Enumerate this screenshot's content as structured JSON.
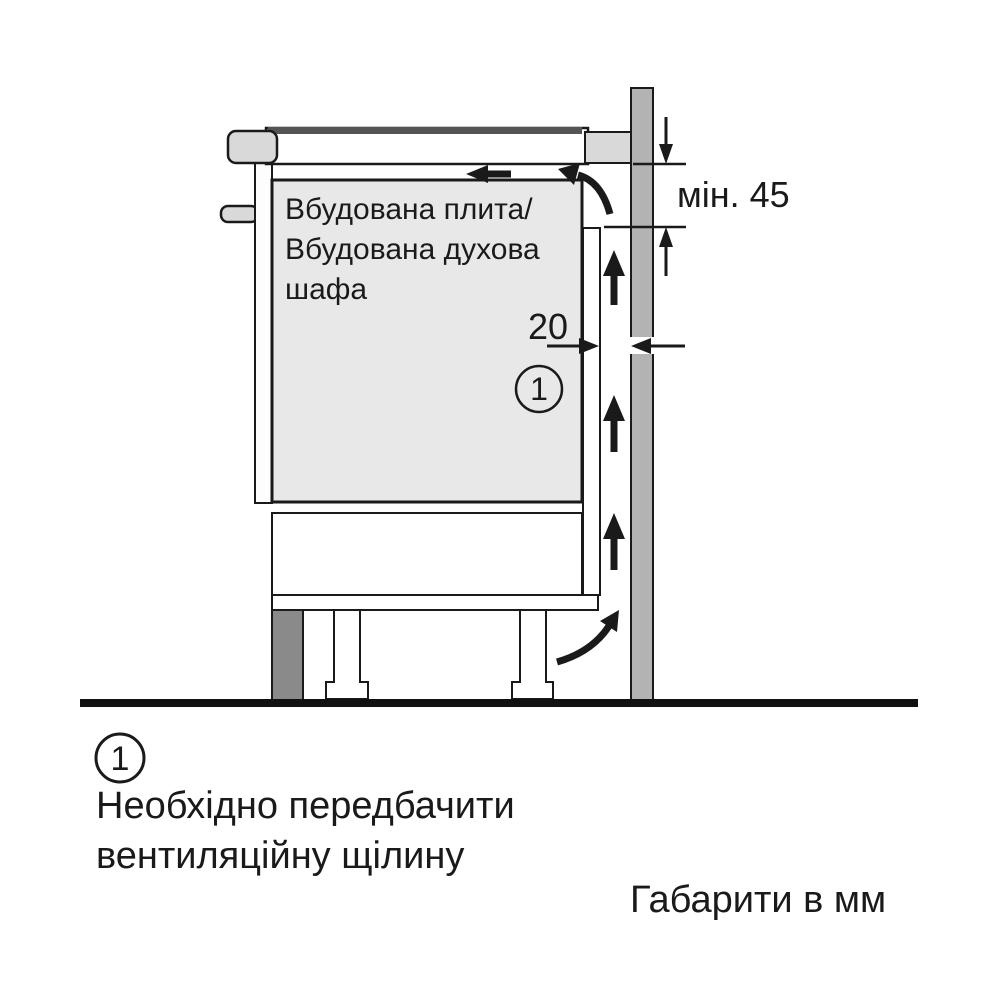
{
  "diagram": {
    "appliance_label": {
      "line1": "Вбудована плита/",
      "line2": "Вбудована духова",
      "line3": "шафа"
    },
    "dim_gap": "20",
    "dim_min_clearance": "мін. 45",
    "callout": "1",
    "colors": {
      "wall": "#b3b3b3",
      "cabinet_fill": "#e8e8e8",
      "panel_gray": "#d9d9d9",
      "leg_dark": "#8a8a8a",
      "line": "#1a1a1a"
    }
  },
  "footnote": {
    "marker": "1",
    "line1": "Необхідно передбачити",
    "line2": "вентиляційну щілину"
  },
  "units_label": "Габарити в мм"
}
